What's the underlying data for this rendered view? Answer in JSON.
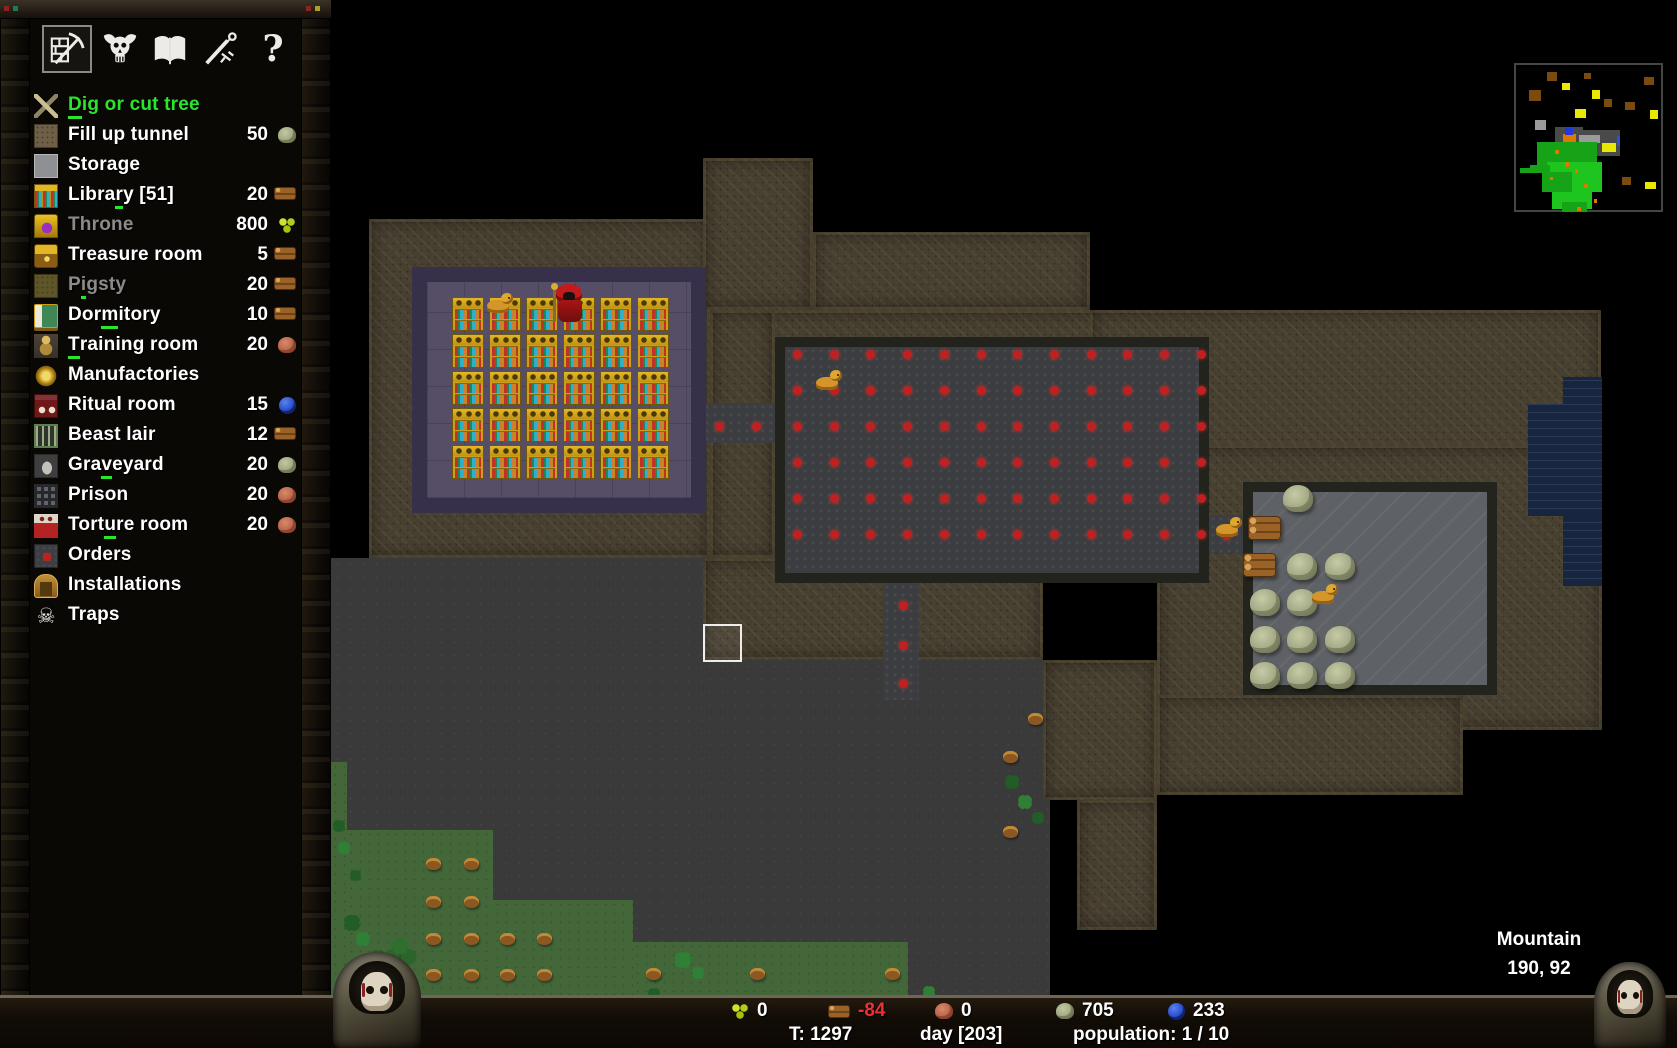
{
  "toolbar": {
    "tabs": [
      {
        "icon": "pickaxe-wall-icon",
        "name": "build",
        "selected": true
      },
      {
        "icon": "horned-skull-icon",
        "name": "minions",
        "selected": false
      },
      {
        "icon": "open-book-icon",
        "name": "technology",
        "selected": false
      },
      {
        "icon": "sword-icon",
        "name": "military",
        "selected": false
      },
      {
        "icon": "question-mark-icon",
        "name": "help",
        "selected": false
      }
    ],
    "help_glyph": "?"
  },
  "sidebar": {
    "items": [
      {
        "label": "Dig or cut tree",
        "state": "active",
        "hotkey_index": 0,
        "icon": "dig",
        "cost": null
      },
      {
        "label": "Fill up tunnel",
        "state": "normal",
        "hotkey_index": -1,
        "icon": "tunnel",
        "cost": {
          "value": "50",
          "resource": "stone"
        }
      },
      {
        "label": "Storage",
        "state": "normal",
        "hotkey_index": -1,
        "icon": "storage",
        "cost": null
      },
      {
        "label": "Library [51]",
        "state": "normal",
        "hotkey_index": 5,
        "icon": "library",
        "cost": {
          "value": "20",
          "resource": "wood"
        }
      },
      {
        "label": "Throne",
        "state": "disabled",
        "hotkey_index": -1,
        "icon": "throne",
        "cost": {
          "value": "800",
          "resource": "mana"
        }
      },
      {
        "label": "Treasure room",
        "state": "normal",
        "hotkey_index": -1,
        "icon": "treasure",
        "cost": {
          "value": "5",
          "resource": "wood"
        }
      },
      {
        "label": "Pigsty",
        "state": "disabled",
        "hotkey_index": 1,
        "icon": "pigsty",
        "cost": {
          "value": "20",
          "resource": "wood"
        }
      },
      {
        "label": "Dormitory",
        "state": "normal",
        "hotkey_index": 3,
        "icon": "dormitory",
        "cost": {
          "value": "10",
          "resource": "wood"
        }
      },
      {
        "label": "Training room",
        "state": "normal",
        "hotkey_index": 0,
        "icon": "training",
        "cost": {
          "value": "20",
          "resource": "iron"
        }
      },
      {
        "label": "Manufactories",
        "state": "normal",
        "hotkey_index": -1,
        "icon": "manufactory",
        "cost": null
      },
      {
        "label": "Ritual room",
        "state": "normal",
        "hotkey_index": -1,
        "icon": "ritual",
        "cost": {
          "value": "15",
          "resource": "gem"
        }
      },
      {
        "label": "Beast lair",
        "state": "normal",
        "hotkey_index": -1,
        "icon": "beast",
        "cost": {
          "value": "12",
          "resource": "wood"
        }
      },
      {
        "label": "Graveyard",
        "state": "normal",
        "hotkey_index": 3,
        "icon": "graveyard",
        "cost": {
          "value": "20",
          "resource": "stone"
        }
      },
      {
        "label": "Prison",
        "state": "normal",
        "hotkey_index": -1,
        "icon": "prison",
        "cost": {
          "value": "20",
          "resource": "iron"
        }
      },
      {
        "label": "Torture room",
        "state": "normal",
        "hotkey_index": 4,
        "icon": "torture",
        "cost": {
          "value": "20",
          "resource": "iron"
        }
      },
      {
        "label": "Orders",
        "state": "normal",
        "hotkey_index": -1,
        "icon": "orders",
        "cost": null
      },
      {
        "label": "Installations",
        "state": "normal",
        "hotkey_index": -1,
        "icon": "installations",
        "cost": null
      },
      {
        "label": "Traps",
        "state": "normal",
        "hotkey_index": -1,
        "icon": "traps",
        "cost": null
      }
    ]
  },
  "status": {
    "speed_label": "speed:",
    "speed_value": "paused",
    "fps": "FPS 59 / 47"
  },
  "bottom_bar": {
    "resources": [
      {
        "icon": "mana",
        "value": "0"
      },
      {
        "icon": "wood",
        "value": "-84"
      },
      {
        "icon": "iron",
        "value": "0"
      },
      {
        "icon": "stone",
        "value": "705"
      },
      {
        "icon": "gem",
        "value": "233"
      }
    ],
    "turn": "T: 1297",
    "day": "day [203]",
    "population": "population: 1 / 10"
  },
  "map": {
    "location_name": "Mountain",
    "cursor_coords": "190, 92",
    "rooms": [
      {
        "name": "library",
        "floor": "purple",
        "shelves_cols": 6,
        "shelves_rows": 5
      },
      {
        "name": "excavated-hall",
        "floor": "cobblestone-with-red-markers"
      },
      {
        "name": "storage-area",
        "floor": "gray-stone"
      }
    ],
    "creatures": [
      {
        "type": "keeper",
        "location": "library"
      },
      {
        "type": "imp",
        "location": "library"
      },
      {
        "type": "imp",
        "location": "excavated-hall"
      },
      {
        "type": "imp",
        "location": "storage-area"
      },
      {
        "type": "imp",
        "location": "storage-area"
      }
    ],
    "items": [
      {
        "type": "stone-pile",
        "count": 11
      },
      {
        "type": "wood-pile",
        "count": 2
      },
      {
        "type": "tree-stump",
        "count": 15
      },
      {
        "type": "tree",
        "count": 1
      }
    ],
    "colors": {
      "rock": "#473f30",
      "grass": "#44673a",
      "water": "#17253f",
      "library_floor": "#564d66",
      "hall_floor": "#3b3d40",
      "marker_red": "#c02020"
    }
  }
}
